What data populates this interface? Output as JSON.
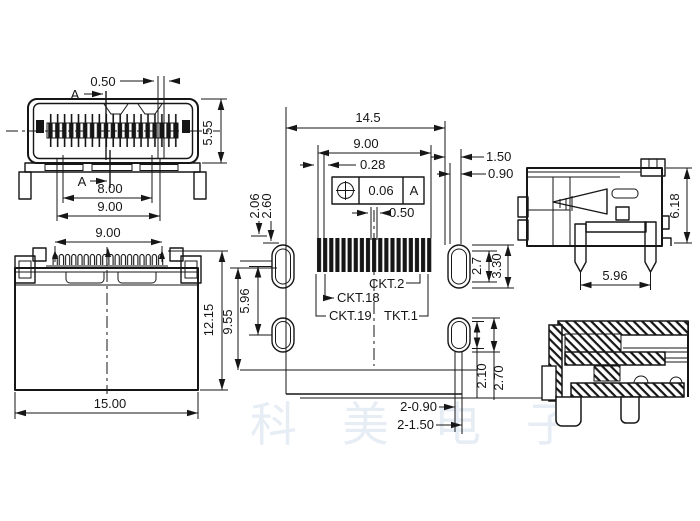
{
  "watermark": "科美电子",
  "front_view": {
    "top_gap": "0.50",
    "section_label": "A",
    "height": "5.55",
    "pin_span": "8.00",
    "width": "9.00"
  },
  "plan_view": {
    "pin_row_width": "9.00",
    "height": "12.15",
    "depth": "9.55",
    "width": "15.00"
  },
  "footprint_view": {
    "total_width": "14.5",
    "pad_span": "9.00",
    "pad_width": "0.28",
    "position_tolerance": "0.06",
    "datum": "A",
    "pad_gap": "0.50",
    "offset_upper": "2.06",
    "offset_lower": "2.60",
    "edge_upper": "1.50",
    "edge_lower": "0.90",
    "slot_inner": "2.7",
    "slot_outer": "3.30",
    "slot_pitch": "5.96",
    "pin2_label": "CKT.2",
    "pin18_label": "CKT.18",
    "pin19_label": "CKT.19",
    "pin1_label": "TKT.1",
    "hole_inner": "2.10",
    "hole_outer": "2.70",
    "hole_small": "2-0.90",
    "hole_large": "2-1.50"
  },
  "side_view": {
    "height": "6.18",
    "pin_pitch": "5.96"
  }
}
